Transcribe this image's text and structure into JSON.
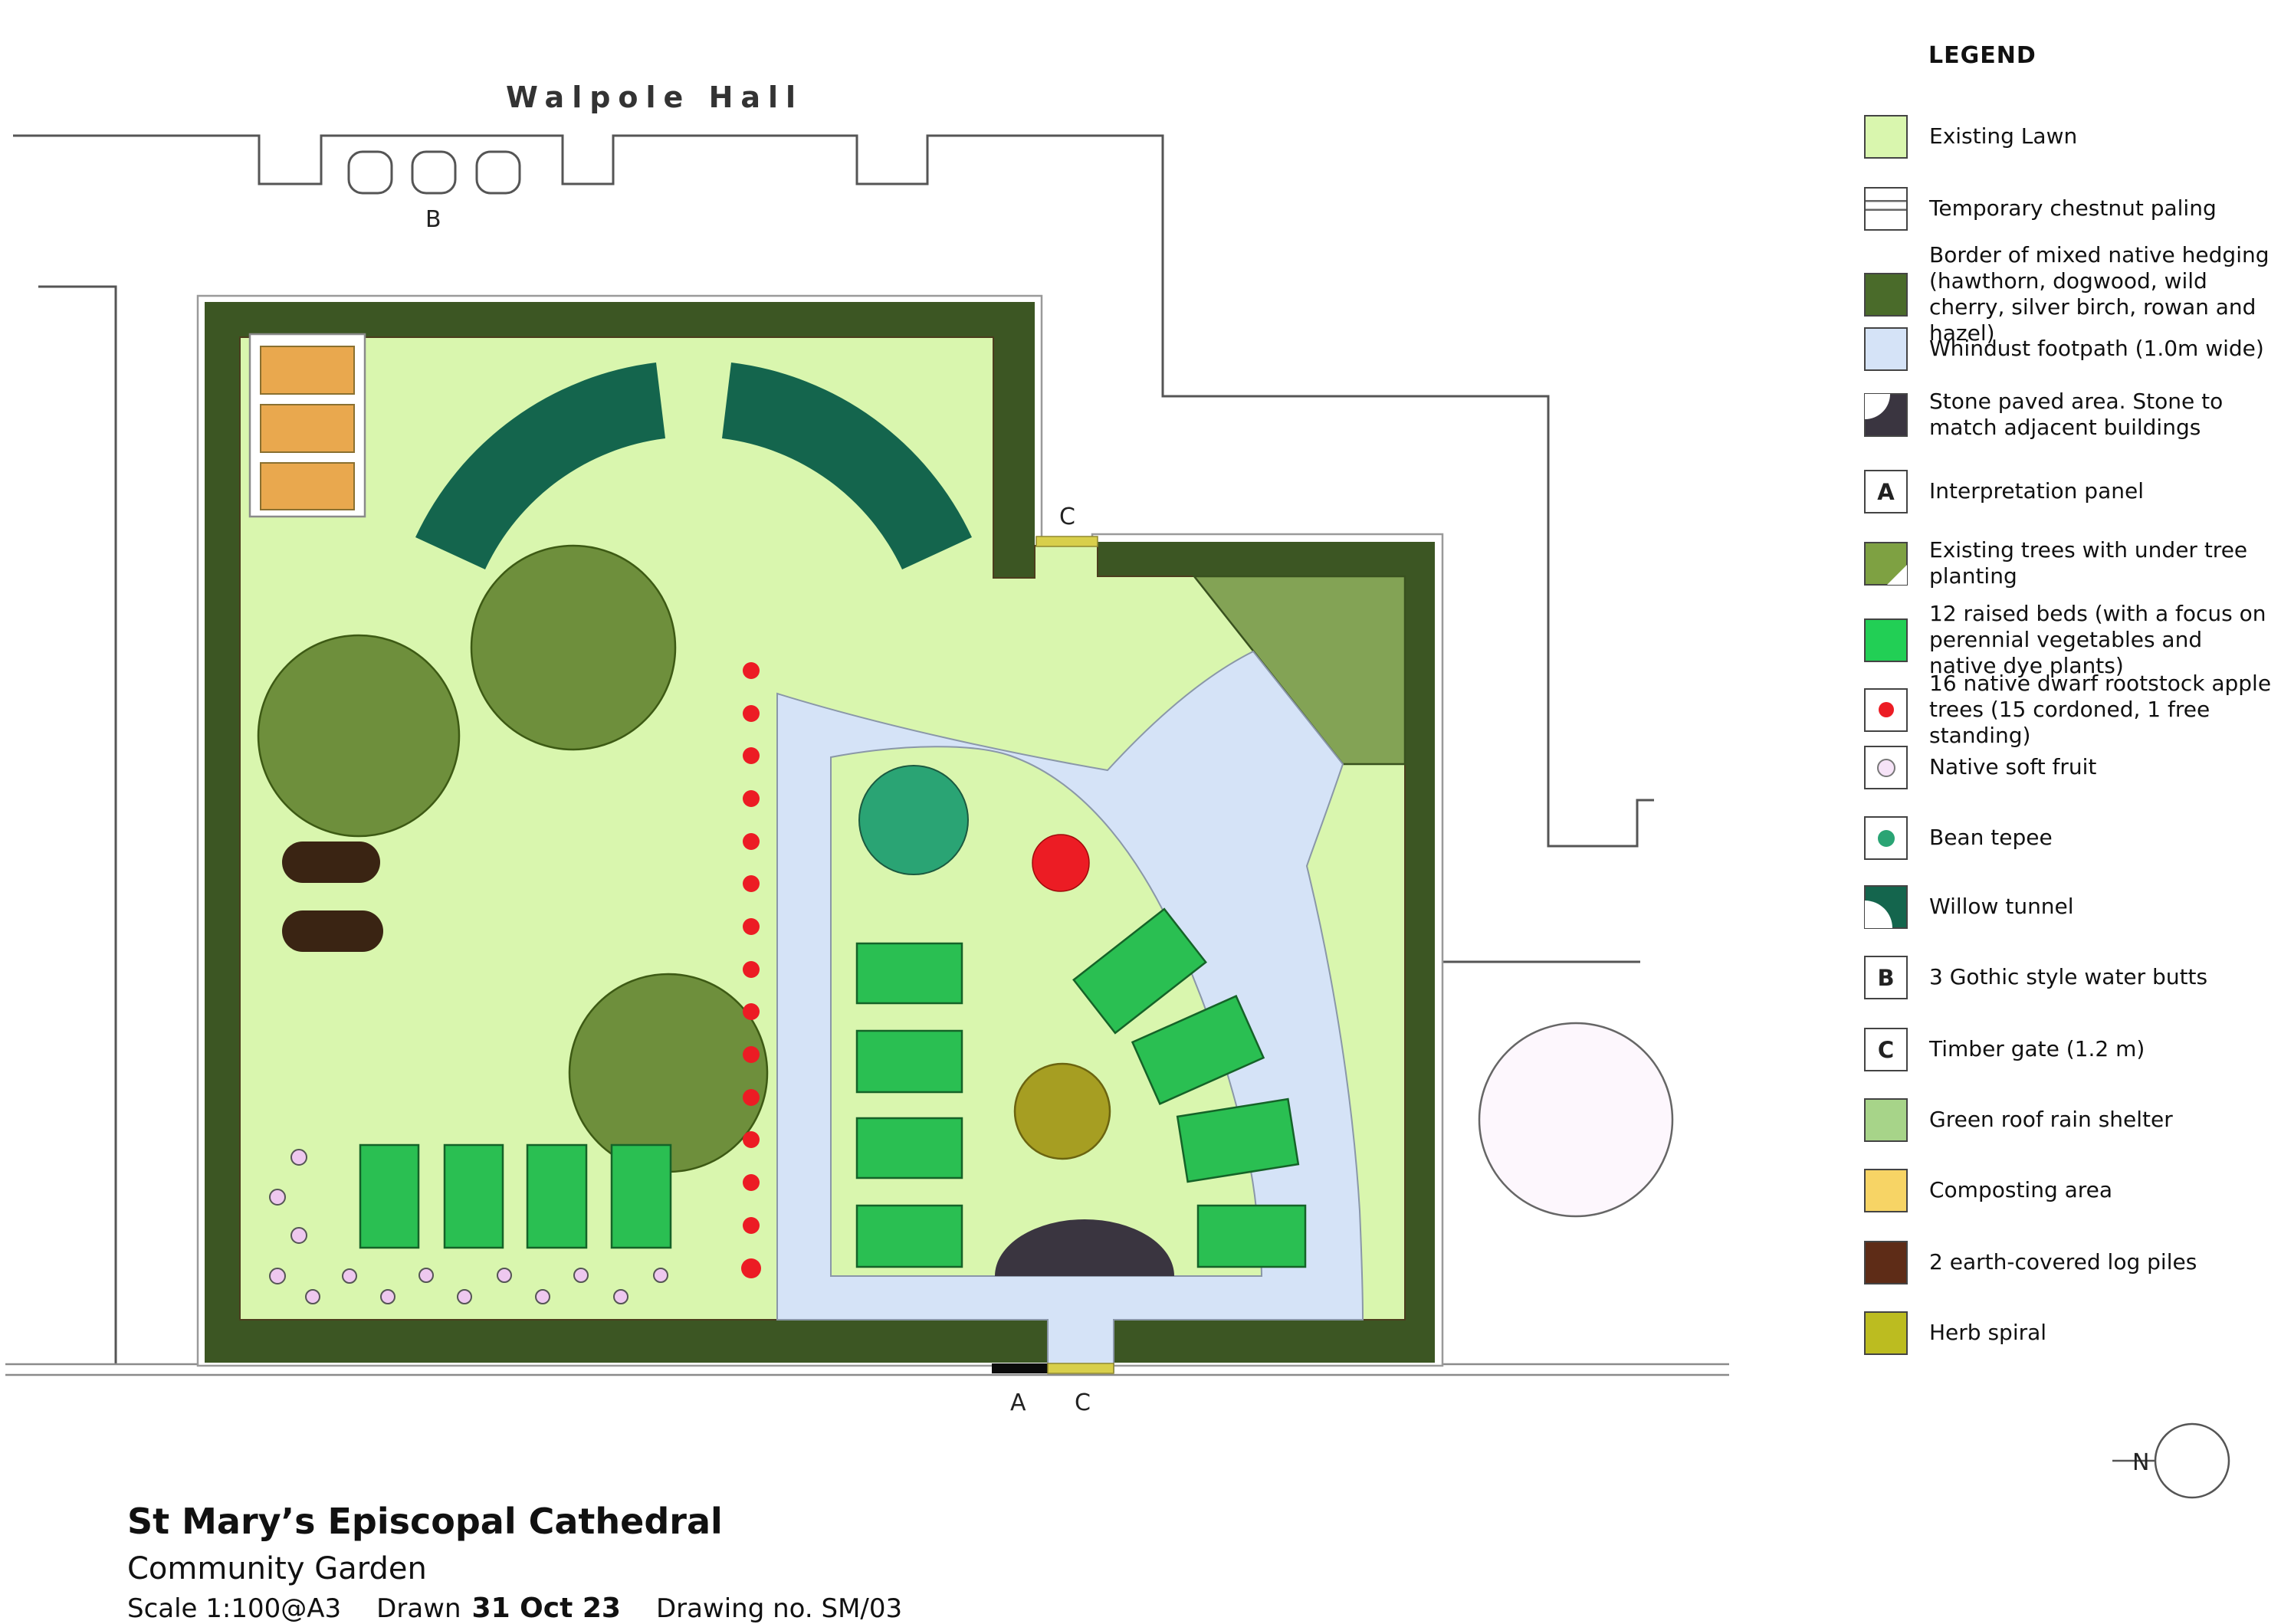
{
  "plan": {
    "labels": {
      "walpole_hall": "Walpole Hall",
      "water_butts_marker": "B",
      "top_gate_marker": "C",
      "panel_marker": "A",
      "bottom_gate_marker": "C",
      "north_marker": "N"
    },
    "features": [
      "hedge-border",
      "existing-lawn",
      "composting-area",
      "willow-tunnel",
      "existing-trees",
      "earth-covered-log-piles",
      "cordoned-apple-trees",
      "native-soft-fruit",
      "raised-beds",
      "whindust-footpath",
      "bean-tepee",
      "free-standing-apple-tree",
      "herb-spiral",
      "stone-paved-area",
      "green-roof-rain-shelter",
      "timber-gates",
      "interpretation-panel",
      "gothic-water-butts",
      "existing-tree-canopy",
      "north-arrow"
    ],
    "counts": {
      "raised_beds": 12,
      "apple_trees_cordoned": 15,
      "apple_trees_free_standing": 1,
      "water_butts": 3,
      "log_piles": 2
    }
  },
  "legend": {
    "title": "LEGEND",
    "items": [
      {
        "label": "Existing Lawn",
        "swatch": {
          "type": "fill",
          "color": "#d9f6ae"
        }
      },
      {
        "label": "Temporary chestnut paling",
        "swatch": {
          "type": "paling",
          "color": "#ffffff"
        }
      },
      {
        "label": "Border of mixed native hedging (hawthorn, dogwood, wild cherry, silver birch, rowan and hazel)",
        "swatch": {
          "type": "fill",
          "color": "#4a6b2a"
        }
      },
      {
        "label": "Whindust footpath (1.0m wide)",
        "swatch": {
          "type": "fill",
          "color": "#d5e3f7"
        }
      },
      {
        "label": "Stone paved area. Stone to match adjacent buildings",
        "swatch": {
          "type": "stone",
          "color": "#3a3540"
        }
      },
      {
        "label": "Interpretation panel",
        "swatch": {
          "type": "letter",
          "color": "#ffffff",
          "letter": "A"
        }
      },
      {
        "label": "Existing trees with under tree planting",
        "swatch": {
          "type": "tree",
          "color": "#7ea142"
        }
      },
      {
        "label": "12 raised beds (with a focus on perennial vegetables and native dye plants)",
        "swatch": {
          "type": "fill",
          "color": "#22cf55"
        }
      },
      {
        "label": "16 native dwarf rootstock apple trees (15 cordoned, 1 free standing)",
        "swatch": {
          "type": "dot",
          "color": "#ffffff",
          "dot_color": "#ec1c24",
          "dot_size": 20
        }
      },
      {
        "label": "Native soft fruit",
        "swatch": {
          "type": "dot",
          "color": "#ffffff",
          "dot_color": "#f6e3f7",
          "dot_border": "#777",
          "dot_size": 20
        }
      },
      {
        "label": "Bean tepee",
        "swatch": {
          "type": "dot",
          "color": "#ffffff",
          "dot_color": "#2aa474",
          "dot_size": 22
        }
      },
      {
        "label": "Willow tunnel",
        "swatch": {
          "type": "willow",
          "color": "#14654d"
        }
      },
      {
        "label": "3 Gothic style water butts",
        "swatch": {
          "type": "letter",
          "color": "#ffffff",
          "letter": "B"
        }
      },
      {
        "label": "Timber gate (1.2 m)",
        "swatch": {
          "type": "letter",
          "color": "#ffffff",
          "letter": "C"
        }
      },
      {
        "label": "Green roof rain shelter",
        "swatch": {
          "type": "fill",
          "color": "#a7d489"
        }
      },
      {
        "label": "Composting area",
        "swatch": {
          "type": "fill",
          "color": "#f7d465"
        }
      },
      {
        "label": "2 earth-covered log piles",
        "swatch": {
          "type": "fill",
          "color": "#5e2c17"
        }
      },
      {
        "label": "Herb spiral",
        "swatch": {
          "type": "fill",
          "color": "#bcbc20"
        }
      }
    ]
  },
  "title_block": {
    "site": "St Mary’s Episcopal Cathedral",
    "project": "Community Garden",
    "scale_label": "Scale 1:100@A3",
    "drawn_label": "Drawn",
    "drawn_date": "31 Oct 23",
    "drawing_no": "Drawing no. SM/03"
  },
  "colors": {
    "lawn": "#d9f6ae",
    "hedge": "#3c5623",
    "path": "#d5e3f7",
    "pathline": "#8a97a8",
    "arc": "#14654d",
    "tree": "#6e8f3c",
    "treeline": "#3d5a14",
    "bed": "#2abf52",
    "bedline": "#156328",
    "log": "#3a2413",
    "red": "#ec1c24",
    "tepee": "#2aa474",
    "herb": "#a69e22",
    "herbline": "#6b6410",
    "stone": "#3a3540",
    "shelter": "#83a355",
    "compost": "#e9a84e",
    "gate": "#d8cf4b",
    "fruit": "#eec8ef",
    "whitetree": "#fdf7fd",
    "wall": "#555555"
  }
}
